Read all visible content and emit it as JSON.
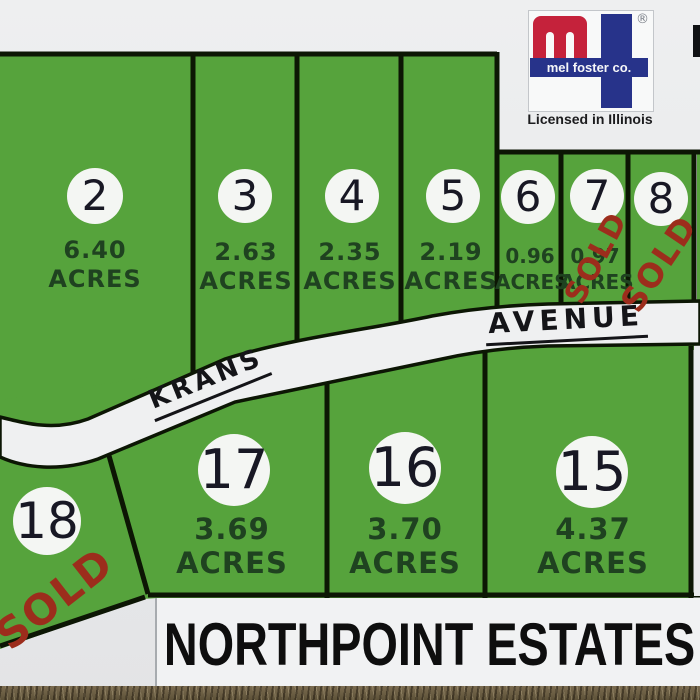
{
  "sign": {
    "title": "NORTHPOINT ESTATES",
    "license": "Licensed in Illinois",
    "brand": "mel foster co.",
    "registered_mark": "®",
    "road": {
      "left_label": "KRANS",
      "right_label": "AVENUE"
    },
    "labels": {
      "acres": "ACRES",
      "sold": "SOLD"
    },
    "lots": [
      {
        "id": "2",
        "acreage": "6.40",
        "sold": false
      },
      {
        "id": "3",
        "acreage": "2.63",
        "sold": false
      },
      {
        "id": "4",
        "acreage": "2.35",
        "sold": false
      },
      {
        "id": "5",
        "acreage": "2.19",
        "sold": false
      },
      {
        "id": "6",
        "acreage": "0.96",
        "sold": false
      },
      {
        "id": "7",
        "acreage": "0.97",
        "sold": true
      },
      {
        "id": "8",
        "acreage": "",
        "sold": true
      },
      {
        "id": "15",
        "acreage": "4.37",
        "sold": false
      },
      {
        "id": "16",
        "acreage": "3.70",
        "sold": false
      },
      {
        "id": "17",
        "acreage": "3.69",
        "sold": false
      },
      {
        "id": "18",
        "acreage": "",
        "sold": true
      }
    ],
    "colors": {
      "lot_green": "#56a33c",
      "lot_border": "#0c1604",
      "sold_red": "#9c2d1c",
      "sign_white": "#eaebec",
      "road_white": "#eff0f1",
      "brand_red": "#c5223b",
      "brand_blue": "#27338a",
      "acres_text": "#1f4220"
    }
  }
}
